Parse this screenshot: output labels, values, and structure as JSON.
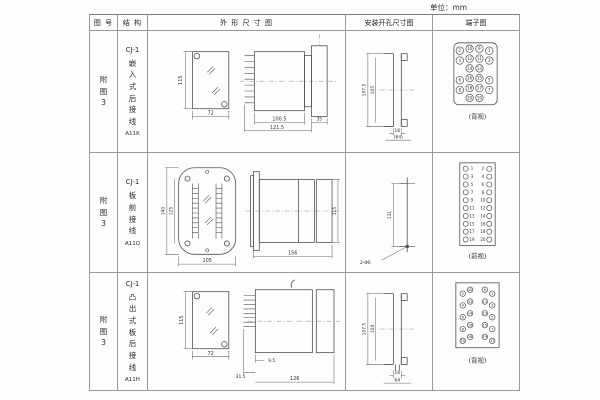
{
  "page": {
    "unit_label": "单位：mm"
  },
  "table": {
    "headers": {
      "col1": "图 号",
      "col2": "结 构",
      "col3": "外 形 尺 寸 图",
      "col4": "安装开孔尺寸图",
      "col5": "端子图"
    },
    "rows": [
      {
        "figure_no": "附图3",
        "model": "CJ-1",
        "structure": "嵌入式后接线",
        "code": "A11K",
        "outline": {
          "height": "115",
          "width": "72",
          "body_length": "100.5",
          "total_length": "121.5",
          "flange_depth": "35"
        },
        "install": {
          "outer_height": "107.5",
          "inner_height": "105",
          "inner_width": "16",
          "outer_width": "(64)"
        },
        "terminal": {
          "caption": "(背视)",
          "r1": [
            "2",
            "10",
            "9",
            "1"
          ],
          "r2": [
            "4",
            "12",
            "11",
            "3"
          ],
          "r3": [
            "14",
            "13"
          ],
          "r4": [
            "6",
            "16",
            "15",
            "5"
          ],
          "r5": [
            "8",
            "18",
            "17",
            "7"
          ],
          "r6": [
            "20",
            "19"
          ]
        }
      },
      {
        "figure_no": "附图3",
        "model": "CJ-1",
        "structure": "板前接线",
        "code": "A11Q",
        "outline": {
          "outer_height": "140",
          "inner_height": "125",
          "width": "105",
          "length": "156",
          "side_height": "115"
        },
        "install": {
          "hole_spacing": "131",
          "hole_label": "2-Φ6"
        },
        "terminal": {
          "caption": "(前视)",
          "left": [
            "1",
            "3",
            "5",
            "7",
            "9",
            "11",
            "13",
            "15",
            "17",
            "19"
          ],
          "right": [
            "2",
            "4",
            "6",
            "8",
            "10",
            "12",
            "14",
            "16",
            "18",
            "20"
          ]
        }
      },
      {
        "figure_no": "附图3",
        "model": "CJ-1",
        "structure": "凸出式板后接线",
        "code": "A11H",
        "outline": {
          "height": "115",
          "width": "72",
          "terminal_depth": "31.5",
          "offset": "9.5",
          "total_length": "126"
        },
        "install": {
          "outer_height": "107.5",
          "inner_height": "104",
          "inner_width": "16",
          "outer_width": "64"
        },
        "terminal": {
          "caption": "(背视)",
          "left": [
            "2",
            "10",
            "4",
            "12",
            "6",
            "14",
            "8",
            "16",
            "20",
            "18"
          ],
          "right": [
            "9",
            "1",
            "11",
            "3",
            "13",
            "5",
            "15",
            "7",
            "19",
            "17"
          ]
        }
      }
    ]
  }
}
